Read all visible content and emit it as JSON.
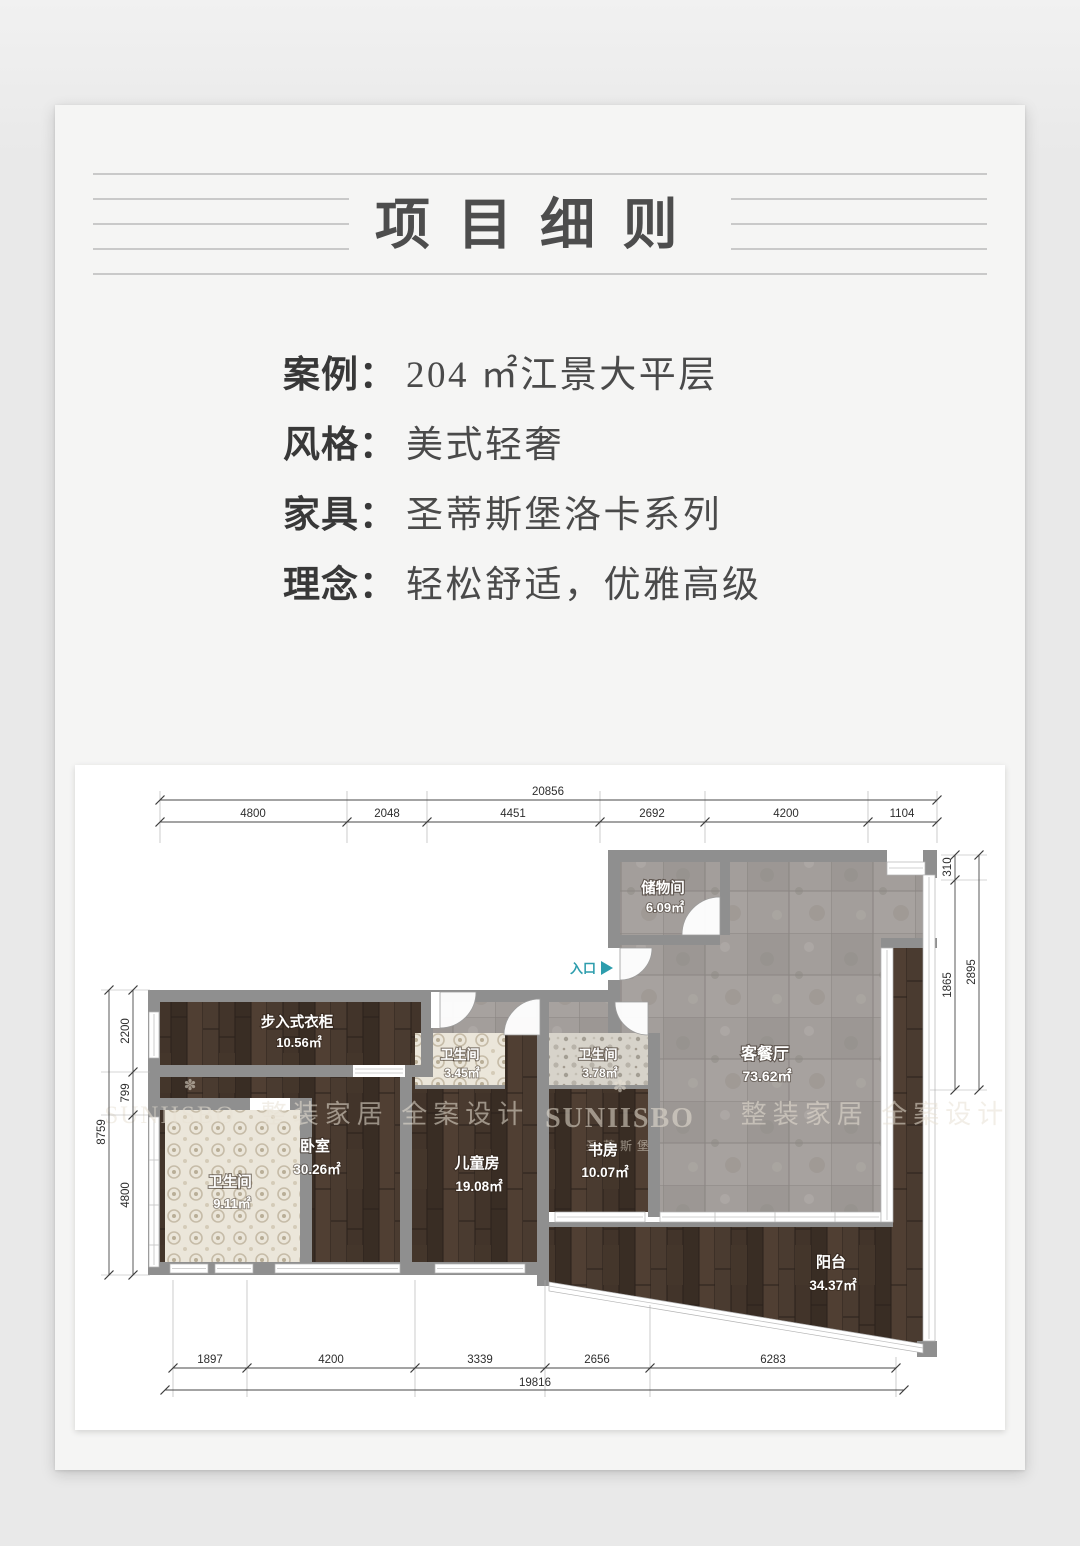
{
  "page": {
    "title": "项目细则"
  },
  "info": {
    "separator": "：",
    "rows": [
      {
        "label": "案例",
        "value": "204 ㎡江景大平层"
      },
      {
        "label": "风格",
        "value": "美式轻奢"
      },
      {
        "label": "家具",
        "value": "圣蒂斯堡洛卡系列"
      },
      {
        "label": "理念",
        "value": "轻松舒适，优雅高级"
      }
    ]
  },
  "floorplan": {
    "entrance_label": "入口",
    "icons": {
      "brand_flower": "✽"
    },
    "rooms": [
      {
        "name": "储物间",
        "area": "6.09㎡"
      },
      {
        "name": "客餐厅",
        "area": "73.62㎡"
      },
      {
        "name": "步入式衣柜",
        "area": "10.56㎡"
      },
      {
        "name": "卫生间",
        "area": "9.11㎡"
      },
      {
        "name": "卧室",
        "area": "30.26㎡"
      },
      {
        "name": "卫生间",
        "area": "3.45㎡"
      },
      {
        "name": "儿童房",
        "area": "19.08㎡"
      },
      {
        "name": "卫生间",
        "area": "3.78㎡"
      },
      {
        "name": "书房",
        "area": "10.07㎡"
      },
      {
        "name": "阳台",
        "area": "34.37㎡"
      }
    ],
    "dims": {
      "top_total": "20856",
      "top_segments": [
        "4800",
        "2048",
        "4451",
        "2692",
        "4200",
        "1104"
      ],
      "right_total": "2895",
      "right_segments": [
        "310",
        "1865"
      ],
      "left_total": "8759",
      "left_segments": [
        "2200",
        "799",
        "4800"
      ],
      "bottom_total": "19816",
      "bottom_segments": [
        "1897",
        "4200",
        "3339",
        "2656",
        "6283"
      ]
    },
    "watermarks": {
      "phrase": "整装家居 全案设计",
      "brand": "SUNIISBO",
      "brand_cn": "圣蒂斯堡"
    },
    "colors": {
      "entrance_accent": "#2d9dad",
      "wall": "#8f8f8f"
    }
  }
}
